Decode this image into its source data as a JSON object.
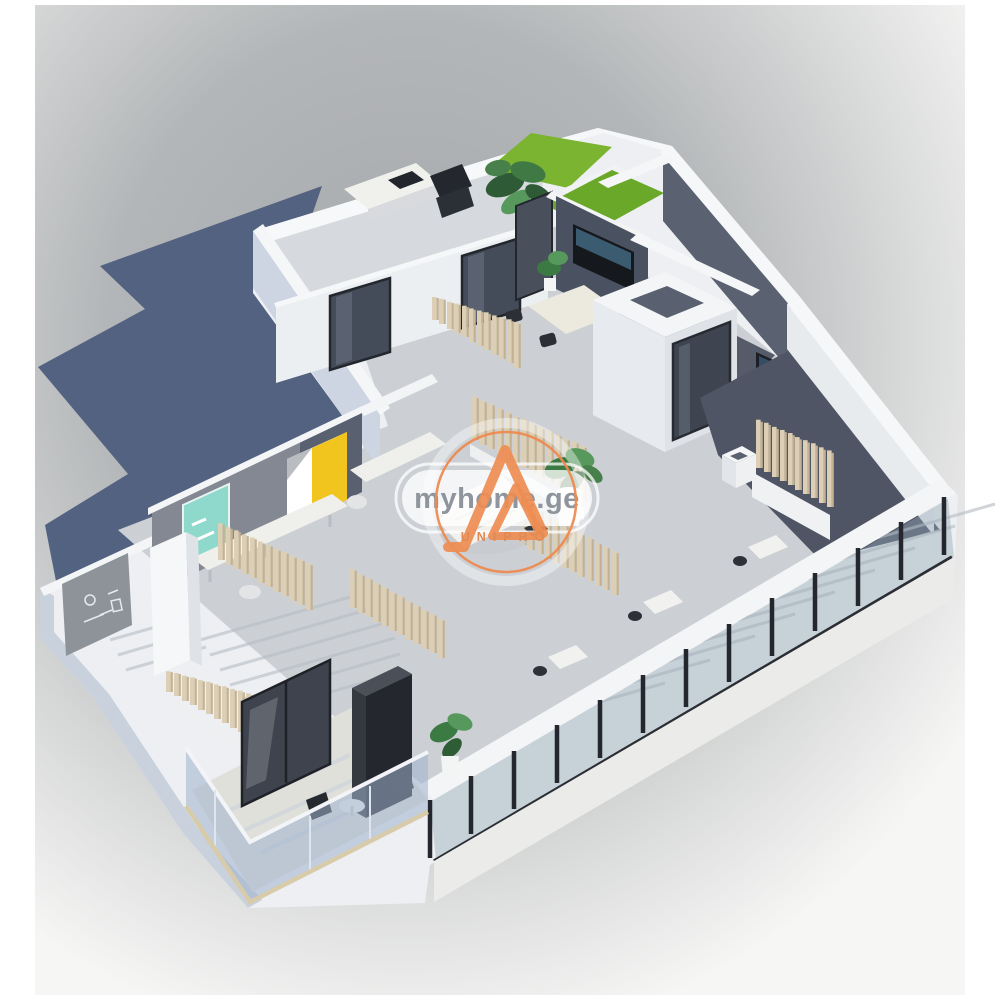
{
  "image": {
    "kind": "3d-isometric-floorplan-render",
    "description": "White 3D apartment model with open-plan rooms, wooden slat partitions, glass facade, balcony and roof lawn on gray studio background with slate-blue cast shadow"
  },
  "watermark": {
    "site_label": "myhome.ge",
    "logo_monogram": "LA",
    "logo_subtext": "UNIPRO",
    "pill_color": "#ffffff",
    "site_text_color": "#8f959d",
    "accent_orange": "#ed8a50"
  },
  "palette": {
    "background_gray": "#b0b3b5",
    "page_white": "#ffffff",
    "shadow_slate": "#4e5f7e",
    "wall_white": "#f4f5f7",
    "wall_shade_blue": "#c9d1dd",
    "floor_gray": "#ccd0d5",
    "dark_accent_wall": "#4a5160",
    "charcoal_block": "#34383f",
    "glass_frame_black": "#24272d",
    "glass_tint": "#94a8b4",
    "wood_slat": "#dccfb6",
    "lawn_green": "#7ab431",
    "plant_green": "#3c7a44",
    "artwork_teal": "#8fd8cc",
    "artwork_yellow": "#f2c51e",
    "balcony_glass": "#9eb2cd",
    "slab_beige": "#d8cbaa"
  },
  "scene": {
    "elements": [
      "cast-shadow",
      "roof-lawn",
      "terrace-desk",
      "monstera-plant",
      "tv-accent-wall",
      "dining-set",
      "bathroom-shaft",
      "dark-terrace",
      "wood-slat-screens",
      "glass-facade",
      "workstations",
      "accent-wall-artworks",
      "chalk-sketch-wall",
      "white-column",
      "sofa",
      "potted-plant",
      "balcony",
      "balcony-glass-railing",
      "dark-wardrobe-block",
      "balcony-table-chairs"
    ]
  }
}
